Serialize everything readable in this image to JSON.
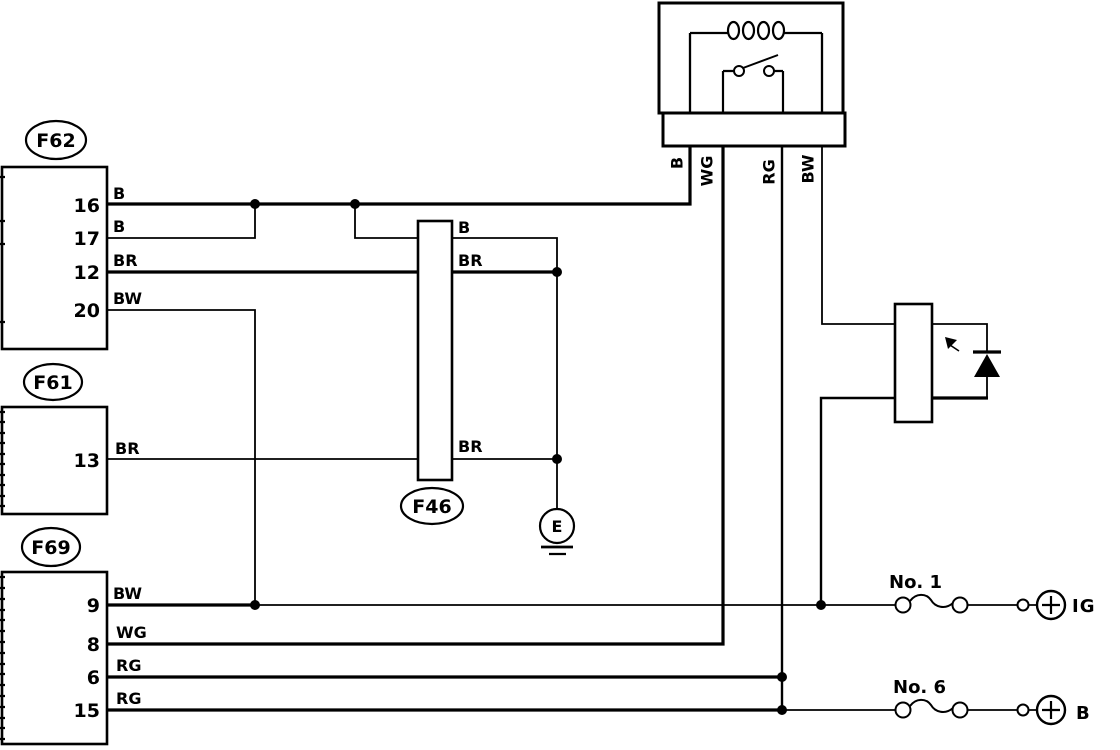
{
  "connectors": {
    "f62": {
      "label": "F62",
      "pins": [
        {
          "num": "16",
          "wire": "B"
        },
        {
          "num": "17",
          "wire": "B"
        },
        {
          "num": "12",
          "wire": "BR"
        },
        {
          "num": "20",
          "wire": "BW"
        }
      ]
    },
    "f61": {
      "label": "F61",
      "pins": [
        {
          "num": "13",
          "wire": "BR"
        }
      ]
    },
    "f69": {
      "label": "F69",
      "pins": [
        {
          "num": "9",
          "wire": "BW"
        },
        {
          "num": "8",
          "wire": "WG"
        },
        {
          "num": "6",
          "wire": "RG"
        },
        {
          "num": "15",
          "wire": "RG"
        }
      ]
    },
    "f46": {
      "label": "F46",
      "right_wires": [
        {
          "wire": "B"
        },
        {
          "wire": "BR"
        },
        {
          "wire": "BR"
        }
      ]
    }
  },
  "relay": {
    "pins": [
      {
        "wire": "B"
      },
      {
        "wire": "WG"
      },
      {
        "wire": "RG"
      },
      {
        "wire": "BW"
      }
    ]
  },
  "ground": {
    "label": "E"
  },
  "fuses": [
    {
      "name": "No. 1",
      "terminal": "IG"
    },
    {
      "name": "No. 6",
      "terminal": "B"
    }
  ],
  "colors": {
    "line": "#000000",
    "background": "#ffffff"
  }
}
